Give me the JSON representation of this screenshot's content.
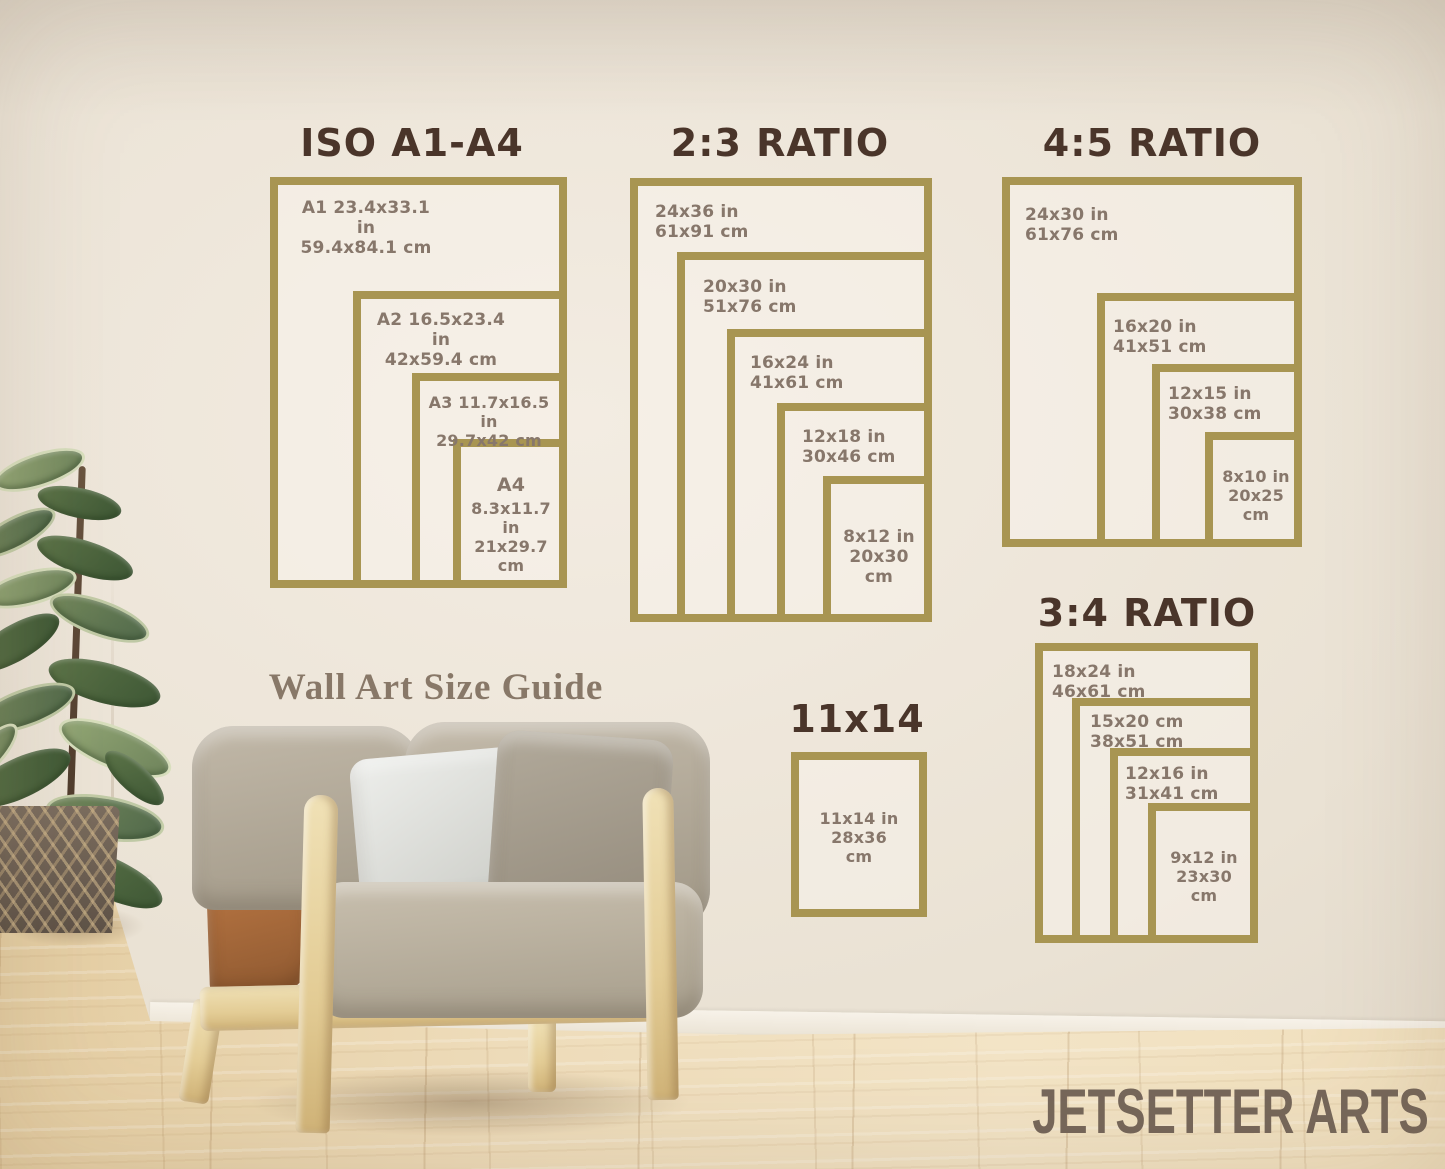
{
  "caption": "Wall Art Size Guide",
  "watermark": "JETSETTER ARTS",
  "colors": {
    "frame_gold": "#a89552",
    "title_brown": "#4a352a",
    "label_brown": "#87776b",
    "wall": "#ece4d8",
    "floor_wood": "#eedcba"
  },
  "sections": {
    "iso": {
      "title": "ISO A1-A4",
      "frames": [
        {
          "name": "A1",
          "lines": [
            "A1 23.4x33.1 in",
            "59.4x84.1 cm"
          ]
        },
        {
          "name": "A2",
          "lines": [
            "A2 16.5x23.4 in",
            "42x59.4 cm"
          ]
        },
        {
          "name": "A3",
          "lines": [
            "A3 11.7x16.5 in",
            "29.7x42 cm"
          ]
        },
        {
          "name": "A4",
          "lines": [
            "A4",
            "8.3x11.7 in",
            "21x29.7",
            "cm"
          ]
        }
      ]
    },
    "r23": {
      "title": "2:3 RATIO",
      "frames": [
        {
          "name": "24x36",
          "lines": [
            "24x36 in",
            "61x91 cm"
          ]
        },
        {
          "name": "20x30",
          "lines": [
            "20x30 in",
            "51x76 cm"
          ]
        },
        {
          "name": "16x24",
          "lines": [
            "16x24 in",
            "41x61 cm"
          ]
        },
        {
          "name": "12x18",
          "lines": [
            "12x18 in",
            "30x46 cm"
          ]
        },
        {
          "name": "8x12",
          "lines": [
            "8x12 in",
            "20x30",
            "cm"
          ]
        }
      ]
    },
    "r45": {
      "title": "4:5 RATIO",
      "frames": [
        {
          "name": "24x30",
          "lines": [
            "24x30 in",
            "61x76 cm"
          ]
        },
        {
          "name": "16x20",
          "lines": [
            "16x20 in",
            "41x51 cm"
          ]
        },
        {
          "name": "12x15",
          "lines": [
            "12x15 in",
            "30x38 cm"
          ]
        },
        {
          "name": "8x10",
          "lines": [
            "8x10 in",
            "20x25",
            "cm"
          ]
        }
      ]
    },
    "r34": {
      "title": "3:4 RATIO",
      "frames": [
        {
          "name": "18x24",
          "lines": [
            "18x24 in",
            "46x61 cm"
          ]
        },
        {
          "name": "15x20",
          "lines": [
            "15x20 cm",
            "38x51 cm"
          ]
        },
        {
          "name": "12x16",
          "lines": [
            "12x16 in",
            "31x41 cm"
          ]
        },
        {
          "name": "9x12",
          "lines": [
            "9x12 in",
            "23x30",
            "cm"
          ]
        }
      ]
    },
    "s1114": {
      "title": "11x14",
      "frames": [
        {
          "name": "11x14",
          "lines": [
            "11x14 in",
            "28x36",
            "cm"
          ]
        }
      ]
    }
  }
}
